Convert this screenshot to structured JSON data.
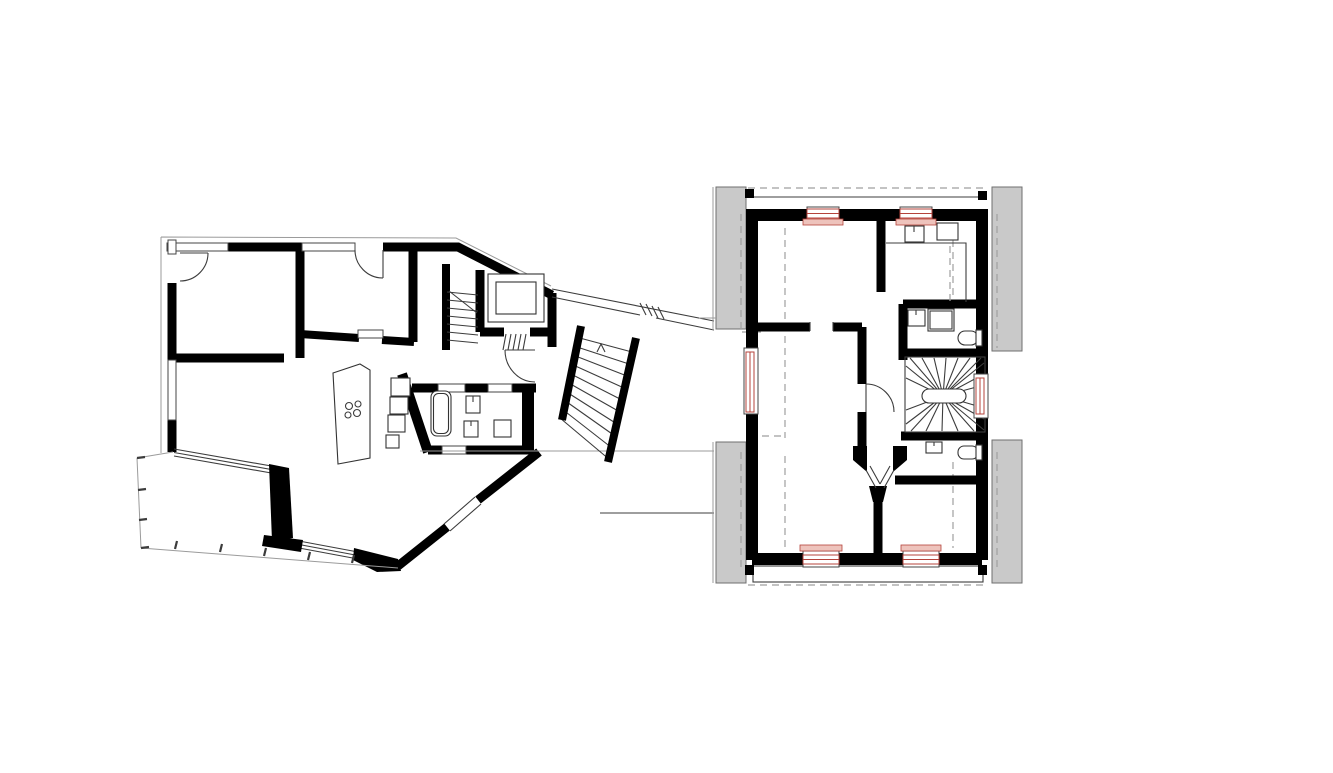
{
  "page": {
    "background": "#ffffff"
  },
  "drawing": {
    "type": "architectural-floor-plan",
    "wings": [
      {
        "name": "annex-ground-floor",
        "elements": [
          "bedroom-1",
          "bedroom-2",
          "living-kitchen",
          "kitchen-island",
          "bathroom",
          "lift",
          "split-level-stair",
          "terrace",
          "glazed-facade"
        ]
      },
      {
        "name": "connecting-link",
        "elements": [
          "straight-stair",
          "corridor-glazing"
        ]
      },
      {
        "name": "main-house-floor",
        "elements": [
          "room-northwest",
          "kitchenette",
          "bathroom-upper",
          "hall",
          "winder-stair",
          "room-west",
          "room-southwest",
          "room-southeast",
          "bathroom-lower",
          "gable-walls",
          "roof-outline-dashed",
          "new-windows-red"
        ]
      }
    ]
  },
  "colors": {
    "background": "#ffffff",
    "wall": "#000000",
    "thin": "#3c3c3c",
    "faint": "#9b9b9b",
    "masonry": "#c9c9c9",
    "masonry_outline": "#6f6f6f",
    "dash": "#9f9f9f",
    "red": "#b5433b",
    "red_fill": "#f6ddd8",
    "sill": "#eec3bc"
  }
}
